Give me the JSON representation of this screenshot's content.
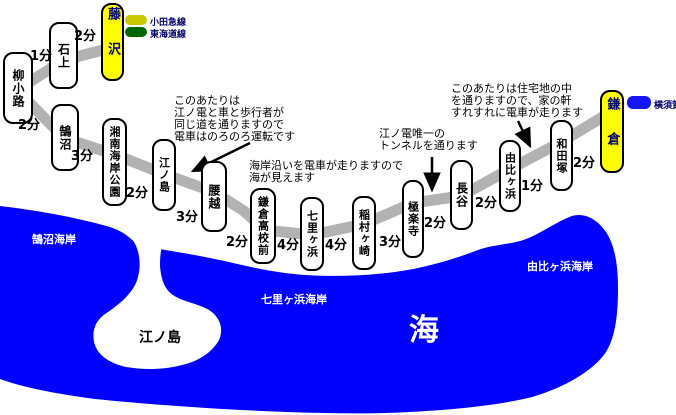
{
  "stations": [
    {
      "name": "柳小路"
    },
    {
      "name": "石上"
    },
    {
      "name": "藤沢",
      "highlight": true
    },
    {
      "name": "鵠沼"
    },
    {
      "name": "湘南海岸公園"
    },
    {
      "name": "江ノ島"
    },
    {
      "name": "腰越"
    },
    {
      "name": "鎌倉高校前"
    },
    {
      "name": "七里ヶ浜"
    },
    {
      "name": "稲村ヶ崎"
    },
    {
      "name": "極楽寺"
    },
    {
      "name": "長谷"
    },
    {
      "name": "由比ヶ浜"
    },
    {
      "name": "和田塚"
    },
    {
      "name": "鎌倉",
      "highlight": true
    }
  ],
  "times": [
    {
      "between": "石上-藤沢",
      "value": "2分"
    },
    {
      "between": "柳小路-石上",
      "value": "1分"
    },
    {
      "between": "柳小路-鵠沼",
      "value": "2分"
    },
    {
      "between": "鵠沼-湘南海岸公園",
      "value": "3分"
    },
    {
      "between": "湘南海岸公園-江ノ島",
      "value": "2分"
    },
    {
      "between": "江ノ島-腰越",
      "value": "3分"
    },
    {
      "between": "腰越-鎌倉高校前",
      "value": "2分"
    },
    {
      "between": "鎌倉高校前-七里ヶ浜",
      "value": "4分"
    },
    {
      "between": "七里ヶ浜-稲村ヶ崎",
      "value": "4分"
    },
    {
      "between": "稲村ヶ崎-極楽寺",
      "value": "3分"
    },
    {
      "between": "極楽寺-長谷",
      "value": "2分"
    },
    {
      "between": "長谷-由比ヶ浜",
      "value": "2分"
    },
    {
      "between": "由比ヶ浜-和田塚",
      "value": "1分"
    },
    {
      "between": "和田塚-鎌倉",
      "value": "2分"
    }
  ],
  "annotations": [
    {
      "lines": [
        "このあたりは",
        "江ノ電と車と歩行者が",
        "同じ道を通りますので",
        "電車はのろのろ運転です"
      ]
    },
    {
      "lines": [
        "海岸沿いを電車が走りますので",
        "海が見えます"
      ]
    },
    {
      "lines": [
        "江ノ電唯一の",
        "トンネルを通ります"
      ]
    },
    {
      "lines": [
        "このあたりは住宅地の中",
        "を通りますので、家の軒",
        "すれすれに電車が走ります"
      ]
    }
  ],
  "connections": [
    {
      "label": "小田急線",
      "color": "#c8c800"
    },
    {
      "label": "東海道線",
      "color": "#006600"
    },
    {
      "label": "横須賀線",
      "color": "#1515ff"
    }
  ],
  "sea": {
    "kugenuma_beach": "鵠沼海岸",
    "shichirigahama_beach": "七里ヶ浜海岸",
    "yuigahama_beach": "由比ヶ浜海岸",
    "sea_big": "海",
    "enoshima_island": "江ノ島"
  },
  "colors": {
    "sea": "#0000ff",
    "track": "#b2b2b2",
    "station_highlight_bg": "#ffff00",
    "station_highlight_text": "#000080",
    "odakyu_line": "#c8c800",
    "tokaido_line": "#006600",
    "yokosuka_line": "#1515ff"
  }
}
